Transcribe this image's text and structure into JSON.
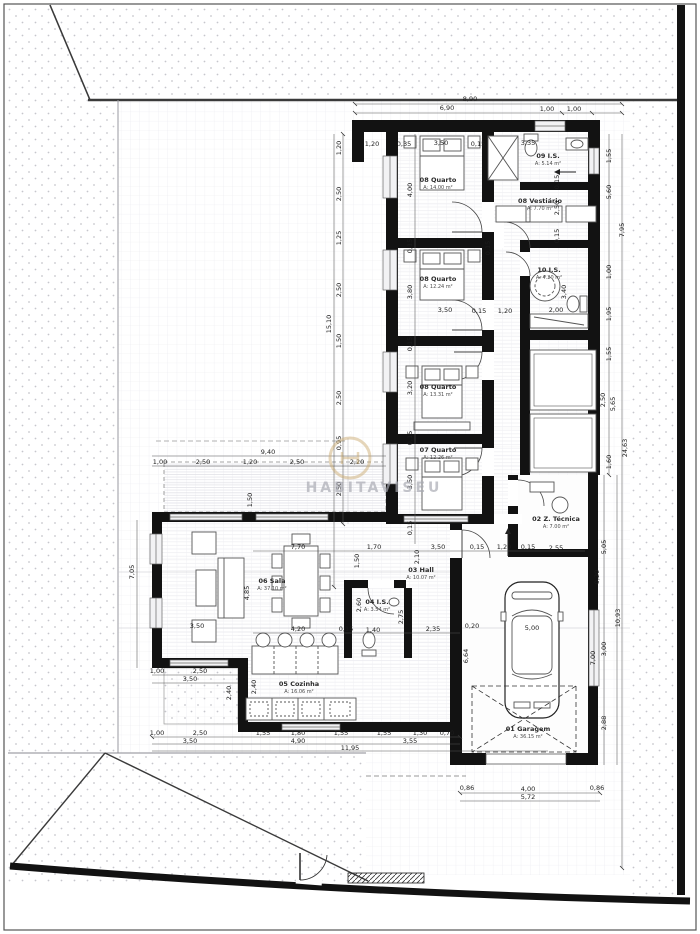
{
  "watermark": {
    "brand": "HABITAVISEU"
  },
  "rooms": [
    {
      "id": "garagem",
      "label": "01 Garagem",
      "area": "A: 36.15 m²"
    },
    {
      "id": "ztecnica",
      "label": "02 Z. Técnica",
      "area": "A: 7.00 m²"
    },
    {
      "id": "hall",
      "label": "03 Hall",
      "area": "A: 10.07 m²"
    },
    {
      "id": "is04",
      "label": "04 I.S.",
      "area": "A: 3.54 m²"
    },
    {
      "id": "cozinha",
      "label": "05 Cozinha",
      "area": "A: 16.06 m²"
    },
    {
      "id": "sala",
      "label": "06 Sala",
      "area": "A: 37.10 m²"
    },
    {
      "id": "quarto07",
      "label": "07 Quarto",
      "area": "A: 12.26 m²"
    },
    {
      "id": "quarto08a",
      "label": "08 Quarto",
      "area": "A: 13.31 m²"
    },
    {
      "id": "quarto08b",
      "label": "08 Quarto",
      "area": "A: 12.24 m²"
    },
    {
      "id": "quarto08c",
      "label": "08 Quarto",
      "area": "A: 14.00 m²"
    },
    {
      "id": "vestiario",
      "label": "08 Vestiário",
      "area": "A: 7.70 m²"
    },
    {
      "id": "is09",
      "label": "09 I.S.",
      "area": "A: 5.14 m²"
    },
    {
      "id": "is10",
      "label": "10 I.S.",
      "area": "A: 4.20 m²"
    }
  ],
  "colors": {
    "wall": "#121212",
    "boundary": "#3a3a3a",
    "grid": "#e9e9ee",
    "stipple": "#c6c6cc",
    "dimension": "#1c1c1c",
    "watermark_ring": "#c9a76c",
    "watermark_text": "#a8a9b2"
  },
  "dims": {
    "d1": "8,90",
    "d2": "6,90",
    "d3": "1,00",
    "d4": "1,00",
    "d5": "1,20",
    "d6": "1,20",
    "d7": "0,35",
    "d8": "3,50",
    "d9": "0,15",
    "d10": "3,35",
    "d11": "1,55",
    "d12": "2,50",
    "d13": "1,25",
    "d14": "2,50",
    "d15": "15,10",
    "d16": "1,50",
    "d17": "2,50",
    "d18": "0,95",
    "d19": "2,50",
    "d20": "4,00",
    "d21": "0,15",
    "d22": "3,80",
    "d23": "0,15",
    "d24": "3,20",
    "d25": "0,15",
    "d26": "3,50",
    "d27": "0,15",
    "d28": "3,50",
    "d29": "0,15",
    "d30": "1,20",
    "d31": "2,00",
    "d32": "2,50",
    "d33": "0,15",
    "d34": "0,15",
    "d35": "3,40",
    "d36": "0,15",
    "d37": "5,60",
    "d38": "7,95",
    "d39": "1,00",
    "d40": "1,95",
    "d41": "1,55",
    "d42": "2,50",
    "d43": "5,65",
    "d44": "24,63",
    "d45": "1,60",
    "d46": "5,05",
    "d47": "0,20",
    "d48": "10,93",
    "d49": "3,00",
    "d50": "7,00",
    "d51": "2,88",
    "d52": "7,70",
    "d53": "1,70",
    "d54": "2,10",
    "d55": "3,50",
    "d56": "0,15",
    "d57": "1,20",
    "d58": "0,15",
    "d59": "2,55",
    "d60": "1,50",
    "d61": "9,40",
    "d62": "1,00",
    "d63": "2,50",
    "d64": "1,20",
    "d65": "2,50",
    "d66": "2,20",
    "d67": "1,50",
    "d68": "7,05",
    "d69": "4,85",
    "d70": "3,50",
    "d71": "4,20",
    "d72": "0,15",
    "d73": "1,40",
    "d74": "2,60",
    "d75": "2,75",
    "d76": "2,35",
    "d77": "2,40",
    "d78": "2,40",
    "d79": "1,00",
    "d80": "2,50",
    "d81": "3,50",
    "d82": "1,00",
    "d83": "2,50",
    "d84": "3,50",
    "d85": "1,55",
    "d86": "1,80",
    "d87": "1,55",
    "d88": "4,90",
    "d89": "11,95",
    "d90": "1,55",
    "d91": "1,30",
    "d92": "0,70",
    "d93": "3,55",
    "d94": "0,86",
    "d95": "4,00",
    "d96": "0,86",
    "d97": "5,72",
    "d98": "5,00",
    "d99": "6,64",
    "d100": "0,20"
  }
}
